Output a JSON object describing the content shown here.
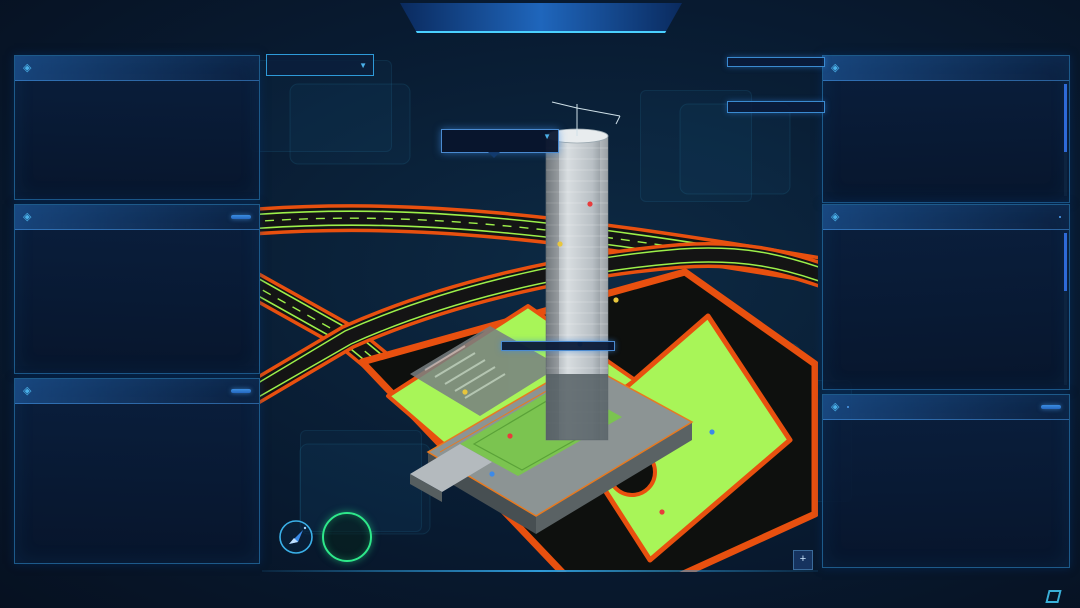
{
  "header": {
    "time": "13:42:24",
    "date": "2022-04-11",
    "left_tabs": [
      {
        "label": "劳务",
        "active": true
      },
      {
        "label": "安全",
        "active": false
      },
      {
        "label": "工期",
        "active": false
      }
    ],
    "title": "苏州工业园区恒泰市民服务中心项目",
    "right_tabs": [
      {
        "label": "管理行为",
        "active": false
      },
      {
        "label": "视频监控",
        "active": false
      },
      {
        "label": "热力图",
        "active": false
      }
    ]
  },
  "left": {
    "records": {
      "title": "进出场记录",
      "rows": [
        {
          "name": "韩成才",
          "group": "邓传听班组",
          "event": "出场 04-11 13:10:12"
        },
        {
          "name": "梁刚",
          "group": "邓传听班组",
          "event": "出场 04-11 13:10:12"
        },
        {
          "name": "韩成才",
          "group": "邓传听班组",
          "event": "出场 04-11 13:10:11"
        },
        {
          "name": "韩祝芹",
          "group": "邓传听班组",
          "event": "出场 04-11 13:10:10"
        },
        {
          "name": "要红琼",
          "group": "邓传听班组",
          "event": "出场 04-11 13:10:09"
        }
      ],
      "more_label": "更多>>"
    },
    "attendance_panel": {
      "title": "近七日考勤人数/考勤率",
      "detail_label": "详情"
    },
    "distribution_panel": {
      "title": "近10日所有劳务出勤天数分布",
      "detail_label": "详情"
    }
  },
  "center": {
    "map_select": {
      "value": "地面规划图"
    },
    "stats": [
      {
        "label": "在场工人数",
        "value": "",
        "icon": "worker-icon",
        "color": "#2ad8c8"
      },
      {
        "label": "出勤工人数",
        "value": "48",
        "icon": "calendar-check-icon",
        "color": "#e8c63f"
      },
      {
        "label": "现场工人数",
        "value": "30",
        "icon": "gauge-icon",
        "color": "#3be8b0"
      },
      {
        "label": "现场管理人员总数",
        "value": "10",
        "icon": "people-icon",
        "color": "#f0a03c"
      },
      {
        "label": "异常出勤数",
        "value": "0",
        "icon": "pulse-icon",
        "color": "#3aa6e8"
      }
    ],
    "building_popup": {
      "title": "办公大楼",
      "rows": [
        {
          "label": "总楼层",
          "value": "33层"
        },
        {
          "label": "已建楼层",
          "value": "F1"
        },
        {
          "label": "当前人数",
          "value": "15"
        }
      ]
    },
    "floor_tooltip": {
      "close": "×",
      "rows": [
        {
          "label": "当前楼层",
          "value": "F5"
        },
        {
          "label": "工人人数",
          "value": "10人"
        }
      ]
    },
    "ground_box": {
      "title": "地面",
      "rows": [
        {
          "label": "当前人数:",
          "value": "14"
        }
      ]
    },
    "tower_box": {
      "title": "办公大楼",
      "rows": [
        {
          "label": "总楼层:",
          "value": "33层"
        },
        {
          "label": "当前人数:",
          "value": "26"
        }
      ]
    },
    "today_rate": {
      "value": "0%",
      "label": "今日出勤率"
    }
  },
  "right": {
    "trades": {
      "title": "现场工人工种分布",
      "columns": [
        "工种",
        "人数"
      ],
      "rows": [
        {
          "trade": "泥工",
          "count": "10"
        },
        {
          "trade": "混凝土工",
          "count": "7"
        },
        {
          "trade": "其他",
          "count": "5"
        },
        {
          "trade": "木工",
          "count": "4"
        },
        {
          "trade": "塔司",
          "count": "4"
        }
      ]
    },
    "partners": {
      "title": "共建方情况",
      "tabs": [
        {
          "label": "出勤率",
          "active": true
        },
        {
          "label": "人数",
          "active": false
        }
      ],
      "items": [
        {
          "rank": "1",
          "name": "杭州中汉建筑劳务分包有限公司",
          "value": "60%",
          "color": "#e8498e"
        },
        {
          "rank": "2",
          "name": "江苏川翰建筑设备租赁有限公司",
          "value": "60%",
          "color": "#f08632"
        },
        {
          "rank": "3",
          "name": "吴江恒安建筑机械安装有限公司",
          "value": "55.6%",
          "color": "#3ab4e8"
        },
        {
          "rank": "4",
          "name": "南通众联鑫盛机械设备租赁有限公司",
          "value": "53.8%",
          "color": "#4a8de8"
        },
        {
          "rank": "5",
          "name": "上海长凯岩土工程有限公司",
          "value": "50%",
          "color": "#3a6ae8"
        },
        {
          "rank": "6",
          "name": "江苏法诒建筑安装工程有限公司",
          "value": "35.4%",
          "color": "#7a5ae8"
        }
      ]
    },
    "squad_panel": {
      "tabs": [
        {
          "label": "突击队",
          "active": true
        },
        {
          "label": "零星用工",
          "active": false
        }
      ],
      "detail_label": "详情"
    }
  },
  "footer": {
    "system_name": "星璇项目管理系统",
    "logo_text": "兰笺"
  },
  "chart_data": [
    {
      "id": "attendance",
      "type": "bar-line",
      "title": "近七日考勤人数/考勤率",
      "categories": [
        "04/05",
        "04/06",
        "04/07",
        "04/08",
        "04/09",
        "04/10",
        "04/11"
      ],
      "series": [
        {
          "name": "考勤人数",
          "type": "bar",
          "axis": "left",
          "color": "#2edc86",
          "values": [
            89,
            122,
            127,
            130,
            111,
            116,
            110
          ]
        },
        {
          "name": "考勤率",
          "type": "line",
          "axis": "right",
          "color": "#e8c63f",
          "values": [
            27,
            36,
            37,
            38,
            35,
            35,
            34
          ]
        }
      ],
      "left_axis": {
        "title": "考勤人数",
        "min": 0,
        "max": 150,
        "step": 30
      },
      "right_axis": {
        "title": "考勤率: %",
        "min": 0,
        "max": 100,
        "step": 25
      },
      "legend_position": "top",
      "grid": false
    },
    {
      "id": "work-days-distribution",
      "type": "pie",
      "title": "近10日所有劳务出勤天数分布",
      "center_label": "17%",
      "center_sublabel": "10天",
      "label_suffix": "人",
      "slices": [
        {
          "label": "10天",
          "count": 56,
          "color": "#2e86e8"
        },
        {
          "label": "9天",
          "count": 29,
          "color": "#36a4e8"
        },
        {
          "label": "8天",
          "count": 22,
          "color": "#2ec8a2"
        },
        {
          "label": "7天",
          "count": 8,
          "color": "#8fd44a"
        },
        {
          "label": "6天",
          "count": 6,
          "color": "#c4d84a"
        },
        {
          "label": "5天",
          "count": 7,
          "color": "#e8d44a"
        },
        {
          "label": "4天",
          "count": 6,
          "color": "#e8aa3c"
        },
        {
          "label": "3天",
          "count": 8,
          "color": "#e8823c"
        },
        {
          "label": "2天",
          "count": 4,
          "color": "#e85a50"
        },
        {
          "label": "1天",
          "count": 6,
          "color": "#e84a7e"
        },
        {
          "label": "0天",
          "count": 176,
          "color": "#cc50d8"
        }
      ]
    },
    {
      "id": "squad",
      "type": "bar-line",
      "title": "突击队",
      "categories": [
        "1月",
        "2月",
        "3月",
        "4月",
        "5月",
        "6月",
        "7月",
        "8月",
        "9月",
        "10月",
        "11月",
        "12月"
      ],
      "series": [
        {
          "name": "人数",
          "type": "bar",
          "axis": "left",
          "color": "#2edc86",
          "values": [
            35,
            320,
            150,
            365,
            0,
            335,
            210,
            35,
            395,
            105,
            360,
            235
          ]
        },
        {
          "name": "工时",
          "type": "line",
          "axis": "right",
          "color": "#e8c63f",
          "values": [
            2,
            70,
            5,
            88,
            73,
            10,
            17,
            18,
            5,
            35,
            20,
            37
          ]
        }
      ],
      "left_axis": {
        "title": "人数: 人",
        "min": 0,
        "max": 500,
        "step": 100
      },
      "right_axis": {
        "title": "工时: h",
        "min": 0,
        "max": 100,
        "step": 25
      },
      "legend_position": "top",
      "grid": false
    }
  ]
}
